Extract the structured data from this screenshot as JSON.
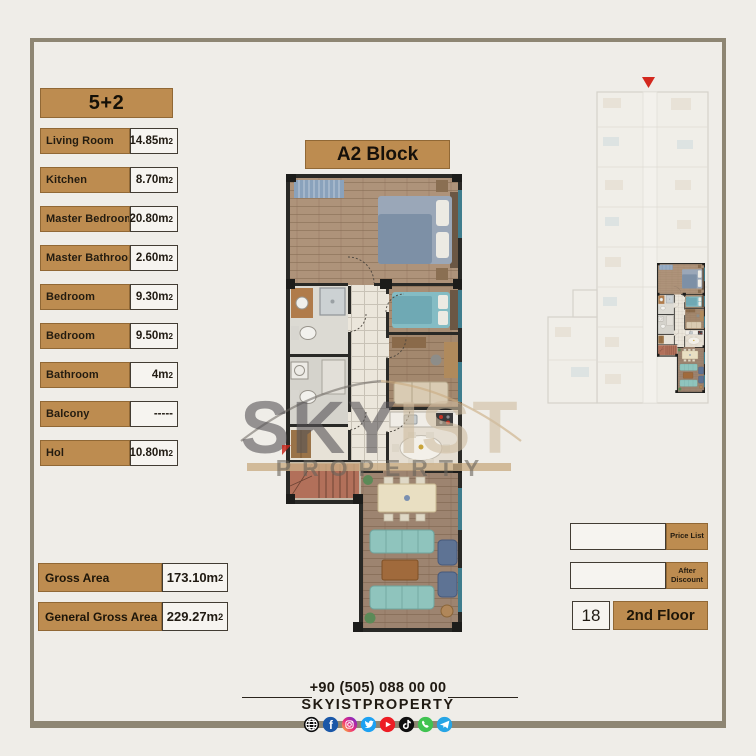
{
  "title_badge": "5+2",
  "block_title": "A2 Block",
  "unit_table": {
    "rows": [
      {
        "label": "Living Room",
        "value": "14.85m2"
      },
      {
        "label": "Kitchen",
        "value": "8.70m2"
      },
      {
        "label": "Master Bedroom",
        "value": "20.80m2"
      },
      {
        "label": "Master Bathroom",
        "value": "2.60m2"
      },
      {
        "label": "Bedroom",
        "value": "9.30m2"
      },
      {
        "label": "Bedroom",
        "value": "9.50m2"
      },
      {
        "label": "Bathroom",
        "value": "4m2"
      },
      {
        "label": "Balcony",
        "value": "-----"
      },
      {
        "label": "Hol",
        "value": "10.80m2"
      }
    ]
  },
  "totals": [
    {
      "label": "Gross Area",
      "value": "173.10m2"
    },
    {
      "label": "General Gross Area",
      "value": "229.27m2"
    }
  ],
  "pricing": {
    "price_list_label": "Price List",
    "price_list_value": "",
    "after_discount_label": "After Discount",
    "after_discount_value": "",
    "unit_number": "18",
    "floor_label": "2nd Floor"
  },
  "footer": {
    "phone": "+90 (505) 088 00 00",
    "brand": "SKYISTPROPERTY",
    "social_icons": [
      "website",
      "facebook",
      "instagram",
      "twitter",
      "youtube",
      "tiktok",
      "whatsapp",
      "telegram"
    ]
  },
  "watermark": {
    "brand_primary": "SKY",
    "brand_secondary": "IST",
    "subtitle": "PROPERTY"
  },
  "colors": {
    "accent_tan": "#bd8c50",
    "frame": "#8e8673",
    "background": "#efede8",
    "marker_red": "#d3281e"
  }
}
